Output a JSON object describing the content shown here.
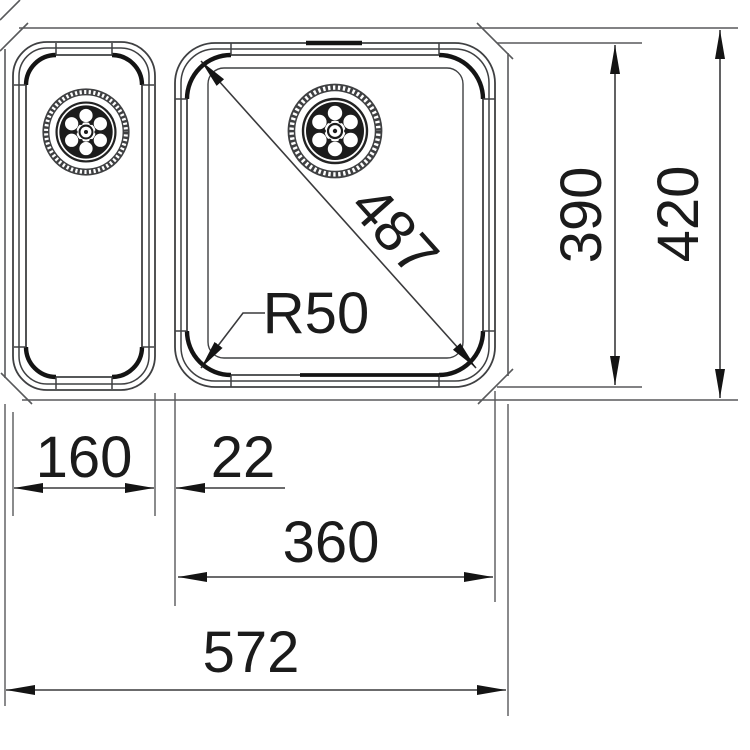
{
  "document": {
    "type": "technical-drawing",
    "subject": "Top view of a 1.5 bowl undermount kitchen sink with two waste drains",
    "units": "mm"
  },
  "dims": {
    "bowl_diagonal": "487",
    "corner_radius": "R50",
    "large_bowl_depth": "390",
    "overall_depth": "420",
    "small_bowl_width": "160",
    "bowl_gap": "22",
    "large_bowl_width": "360",
    "overall_width": "572"
  },
  "colors": {
    "background": "#ffffff",
    "outline": "#58595b",
    "drawing_line": "#3f4042",
    "heavy_line": "#141414",
    "dimension_line": "#4a4a4c",
    "text": "#1b1b1b"
  }
}
